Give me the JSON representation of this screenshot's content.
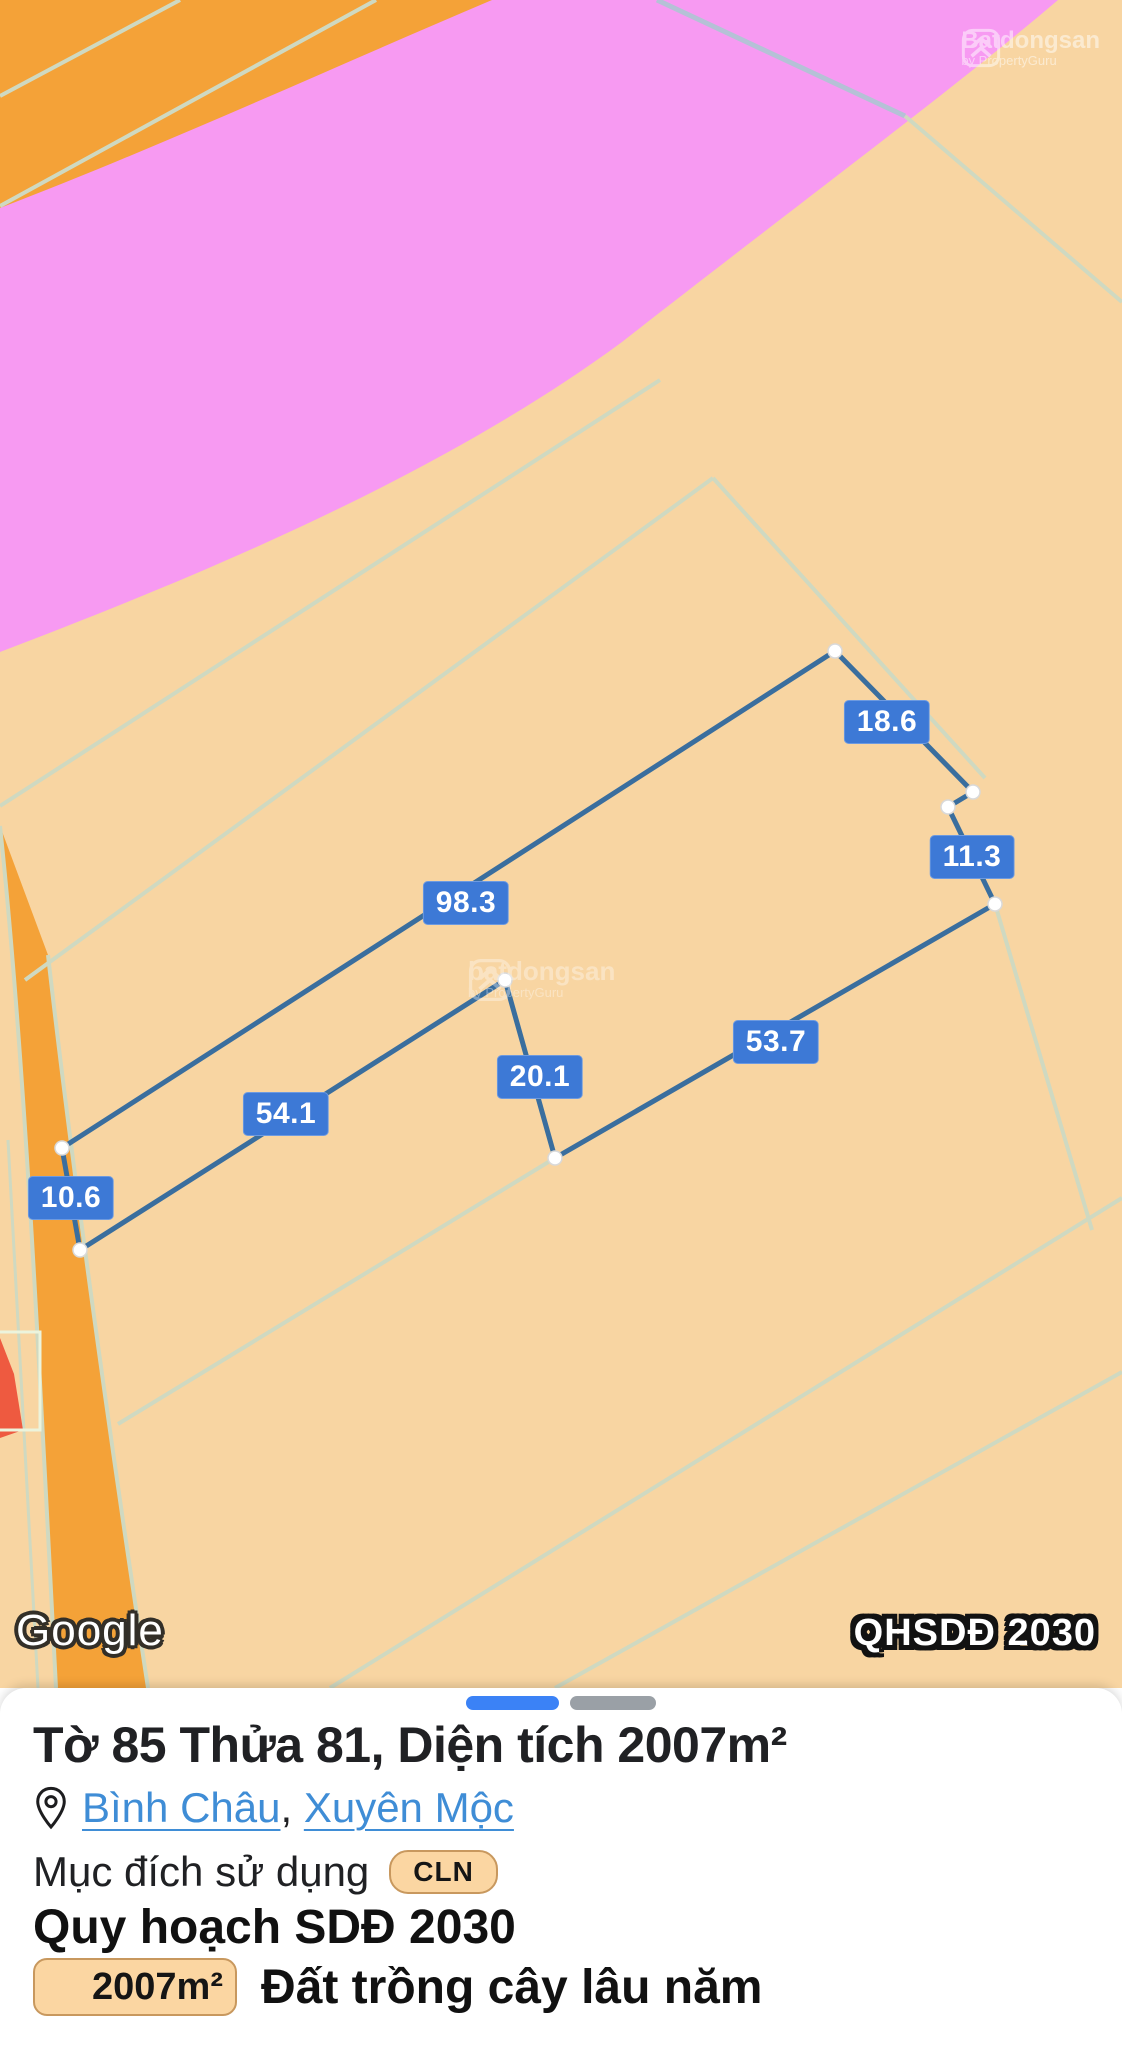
{
  "colors": {
    "zone_tan": "#f8d5a2",
    "zone_pink": "#f79af2",
    "zone_orange": "#f4a238",
    "zone_red_sliver": "#ee5a40",
    "cadastral_line": "#cfd9c1",
    "road_line_grey_blue": "#b5c1d6",
    "parcel_stroke": "#3a6e9e",
    "measure_label_bg": "#3d79d6",
    "link_blue": "#3f8dd6",
    "badge_tan": "#fbd6a2",
    "progress_blue": "#3b82f6",
    "progress_grey": "#9aa0a6"
  },
  "map": {
    "google_logo": "Google",
    "plan_overlay_badge": "QHSDĐ 2030",
    "watermark_top_right": {
      "brand": "Batdongsan",
      "subtitle": "by PropertyGuru"
    },
    "watermark_center": {
      "brand": "batdongsan",
      "subtitle": "by PropertyGuru"
    },
    "parcel": {
      "vertices": [
        [
          835,
          651
        ],
        [
          973,
          792
        ],
        [
          948,
          807
        ],
        [
          995,
          904
        ],
        [
          555,
          1158
        ],
        [
          505,
          980
        ],
        [
          80,
          1250
        ],
        [
          62,
          1148
        ]
      ],
      "edge_labels": [
        {
          "text": "18.6",
          "x": 887,
          "y": 722
        },
        {
          "text": "11.3",
          "x": 972,
          "y": 857
        },
        {
          "text": "98.3",
          "x": 466,
          "y": 903
        },
        {
          "text": "53.7",
          "x": 776,
          "y": 1042
        },
        {
          "text": "20.1",
          "x": 540,
          "y": 1077
        },
        {
          "text": "54.1",
          "x": 286,
          "y": 1114
        },
        {
          "text": "10.6",
          "x": 71,
          "y": 1198
        }
      ]
    }
  },
  "panel": {
    "title": "Tờ 85 Thửa 81, Diện tích 2007m²",
    "location": {
      "ward": "Bình Châu",
      "separator": ",",
      "district": "Xuyên Mộc"
    },
    "purpose": {
      "label": "Mục đích sử dụng",
      "badge": "CLN"
    },
    "plan_heading": "Quy hoạch SDĐ 2030",
    "land_use": {
      "area_badge": "2007m²",
      "type": "Đất trồng cây lâu năm"
    }
  }
}
